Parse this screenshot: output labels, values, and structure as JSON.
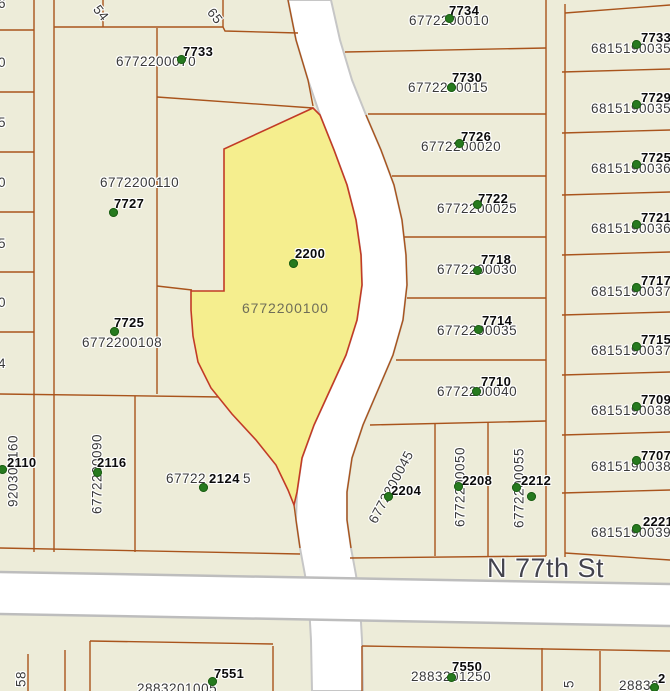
{
  "map": {
    "street_label": "N 77th St",
    "colors": {
      "background": "#edecd9",
      "parcel_line": "#a9541c",
      "selected_parcel_fill": "#f5ee8e",
      "selected_parcel_border": "#c23b26",
      "point_marker_green": "#267a1e",
      "water_and_road_fill": "#ffffff",
      "road_edge_gray": "#bdbdbd",
      "street_label_color": "#43434d",
      "parcel_id_text": "#3a3a3a",
      "selected_parcel_id_text": "#6f6e58"
    },
    "parcels": {
      "p7733": {
        "addr": "7733",
        "id": "6772200070"
      },
      "p7727": {
        "addr": "7727",
        "id": "6772200110"
      },
      "p7725": {
        "addr": "7725",
        "id": "6772200108"
      },
      "p2200": {
        "addr": "2200",
        "id": "6772200100"
      },
      "p2110": {
        "addr": "2110",
        "id": "920300160"
      },
      "p2116": {
        "addr": "2116",
        "id": "6772200090"
      },
      "p2124": {
        "addr": "2124",
        "id_prefix": "67722",
        "id_suffix": "5"
      },
      "p7734": {
        "addr": "7734",
        "id": "6772200010"
      },
      "p7730": {
        "addr": "7730",
        "id": "6772200015"
      },
      "p7726": {
        "addr": "7726",
        "id": "6772200020"
      },
      "p7722": {
        "addr": "7722",
        "id": "6772200025"
      },
      "p7718": {
        "addr": "7718",
        "id": "6772200030"
      },
      "p7714": {
        "addr": "7714",
        "id": "6772200035"
      },
      "p7710": {
        "addr": "7710",
        "id": "6772200040"
      },
      "p2204": {
        "addr": "2204",
        "id": "6772200045"
      },
      "p2208": {
        "addr": "2208",
        "id": "6772200050"
      },
      "p2212": {
        "addr": "2212",
        "id": "6772200055"
      },
      "p7551": {
        "addr": "7551",
        "id": "2883201005"
      },
      "p7550": {
        "addr": "7550",
        "id": "2883201250"
      }
    },
    "east_rows": [
      {
        "addr": "7733",
        "id": "6815190035"
      },
      {
        "addr": "7729",
        "id": "6815190035"
      },
      {
        "addr": "7725",
        "id": "6815190036"
      },
      {
        "addr": "7721",
        "id": "6815190036"
      },
      {
        "addr": "7717",
        "id": "6815190037"
      },
      {
        "addr": "7715",
        "id": "6815190037"
      },
      {
        "addr": "7709",
        "id": "6815190038"
      },
      {
        "addr": "7707",
        "id": "6815190038"
      },
      {
        "addr": "2221",
        "id": "6815190039"
      }
    ],
    "fragments": {
      "top_left_rot": "54",
      "top_mid_rot": "65",
      "left_digits": [
        "6",
        "0",
        "5",
        "0",
        "5",
        "0",
        "4"
      ],
      "bottom_left_vertical": "58",
      "bottom_mid_vertical": "5",
      "bottom_right_id": "28832",
      "bottom_right_addr": "2"
    }
  }
}
